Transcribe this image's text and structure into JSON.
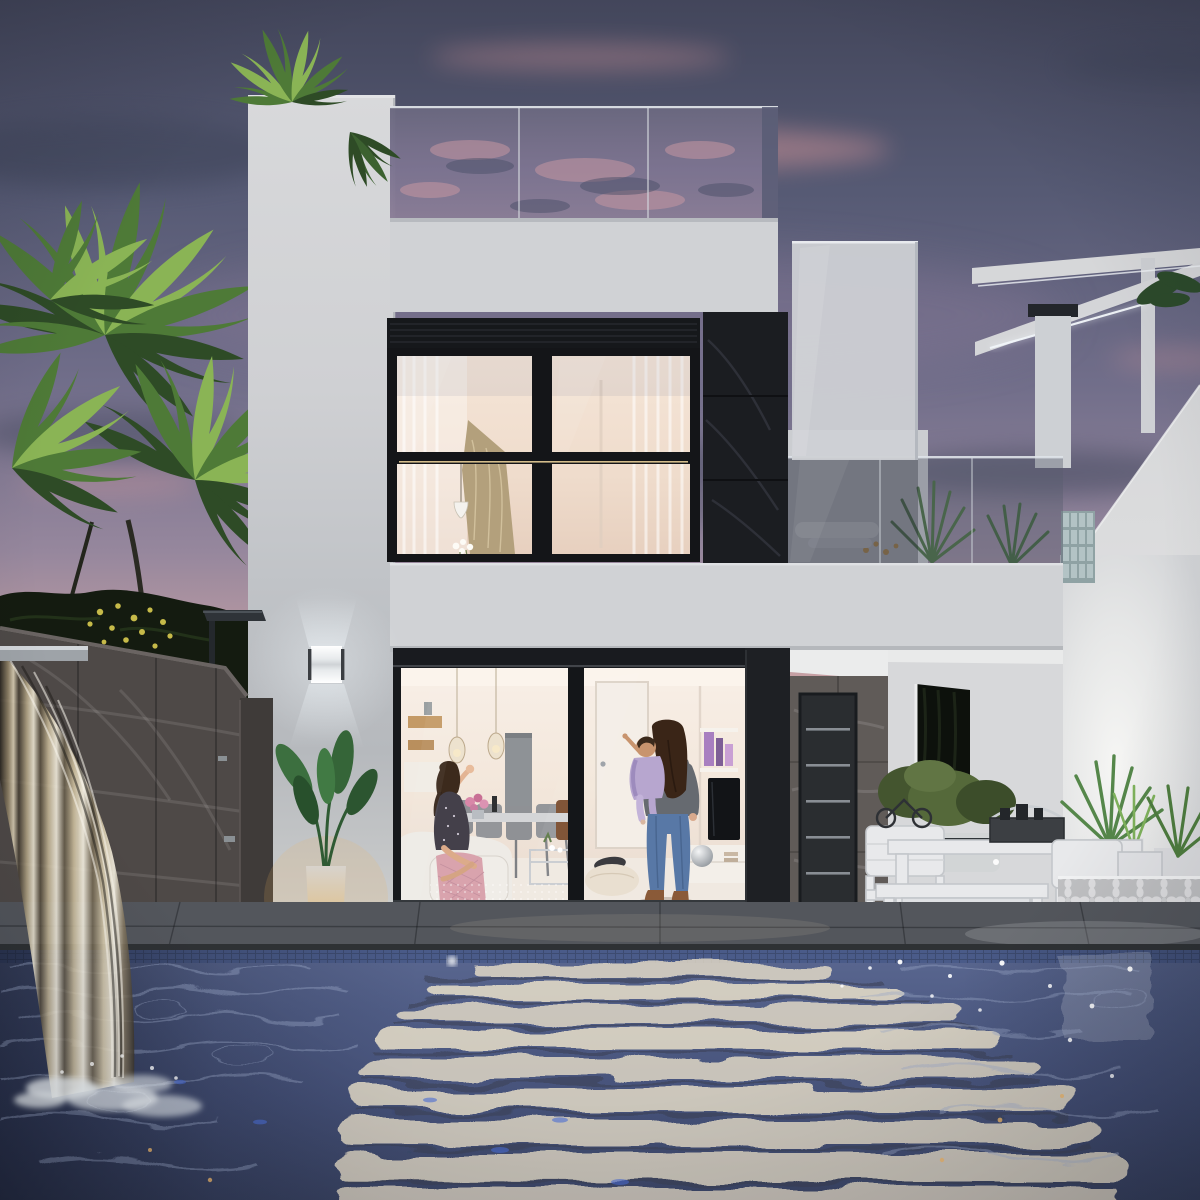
{
  "meta": {
    "title": "Dusk 3D architectural render: modern white two-storey villa with lit interiors, infinity pool, waterfall wall and palm trees",
    "width": 1200,
    "height": 1200
  },
  "scene": {
    "sky": {
      "label": "Purple-pink dusk sky with slate and rose clouds"
    },
    "vegetation": {
      "palms_label": "Tall palm fronds on the left against the sunset",
      "hedge_label": "Dark lemon-tree hedge with yellow fruit above the stone wall",
      "roof_plants_label": "Areca palms on the rooftop terrace",
      "balcony_plants_label": "Yucca plants behind the balcony glass",
      "patio_plants_label": "Spiky grasses in white planters by the breeze-block screen"
    },
    "villa": {
      "label": "White minimalist villa",
      "roof_terrace_label": "Frameless glass balustrade reflecting the sunset",
      "upper_window_label": "Black-framed 2x2 window, warm lit bedroom with curtains, pendant lamp and flowers",
      "stone_column_label": "Charcoal natural-stone feature strip",
      "wall_lamp_label": "Cube up/down LED wall sconce",
      "sliding_door_label": "Full-height sliding glass doors to the lit living room",
      "interior_label": "Living-dining room: white sofa with pink throw, grey dining chairs, glass pendants, TV wall, white sideboard",
      "front_door_label": "Dark entry door with five steel inlays in stone porch",
      "carport_label": "Covered side porch with white car and garden opening"
    },
    "people": [
      {
        "label": "Woman in patterned dress sitting on the sofa, waving"
      },
      {
        "label": "Woman in jeans and brown boots holding a baby in lavender, baby pointing up"
      }
    ],
    "exterior": {
      "stone_wall_label": "Dark stone boundary wall with sheet waterfall into pool",
      "shower_label": "Outdoor shower with square rain head",
      "glow_pot_label": "Illuminated planter with strelitzia plant",
      "furniture_label": "White modern outdoor dining set with cushions",
      "breeze_label": "White decorative breeze-block screen, backlit",
      "neighbor_label": "Neighbouring white house with LED-lit pergola and glass blocks",
      "pool_label": "Mosaic-tiled pool reflecting the warm interior light"
    }
  },
  "colors": {
    "sky_top": "#43465b",
    "sky_mid": "#716e8a",
    "sky_mauve": "#96879d",
    "sky_pink": "#c9a2a4",
    "sky_peach": "#e9bd9b",
    "sky_horizon": "#f2cfae",
    "cloud_pink": "#d8989b",
    "cloud_dark": "#3e4459",
    "palm_dark": "#2e4b26",
    "palm_mid": "#4e7a37",
    "palm_light": "#8ab455",
    "lemon_yellow": "#d6c84e",
    "wall_white": "#d7d8da",
    "wall_shade": "#b9bcc0",
    "parapet": "#d0d2d5",
    "stone_black": "#1b1d21",
    "stone_wall": "#4e4947",
    "porch_stone": "#605b58",
    "frame_black": "#17191c",
    "interior_warm": "#f6ece4",
    "window_warm": "#f2e1d2",
    "glass_roof": "#6f6d88",
    "glass_balcony": "#5f6473",
    "deck": "#5b5e63",
    "coping": "#2e3134",
    "waterline": "#3d4b70",
    "water_deep": "#46527a",
    "water_dark": "#39405a",
    "water_light": "#9aa7c6",
    "reflection_cream": "#e9dfc9",
    "foam_white": "#eef3f6",
    "lamp_white": "#f1f6f9",
    "pot_glow": "#f0b45e",
    "led_white": "#f2f6fa",
    "jeans_blue": "#5878a6",
    "skin": "#d9a98c",
    "baby_lavender": "#b7a6cf",
    "throw_pink": "#d9a3ad"
  }
}
